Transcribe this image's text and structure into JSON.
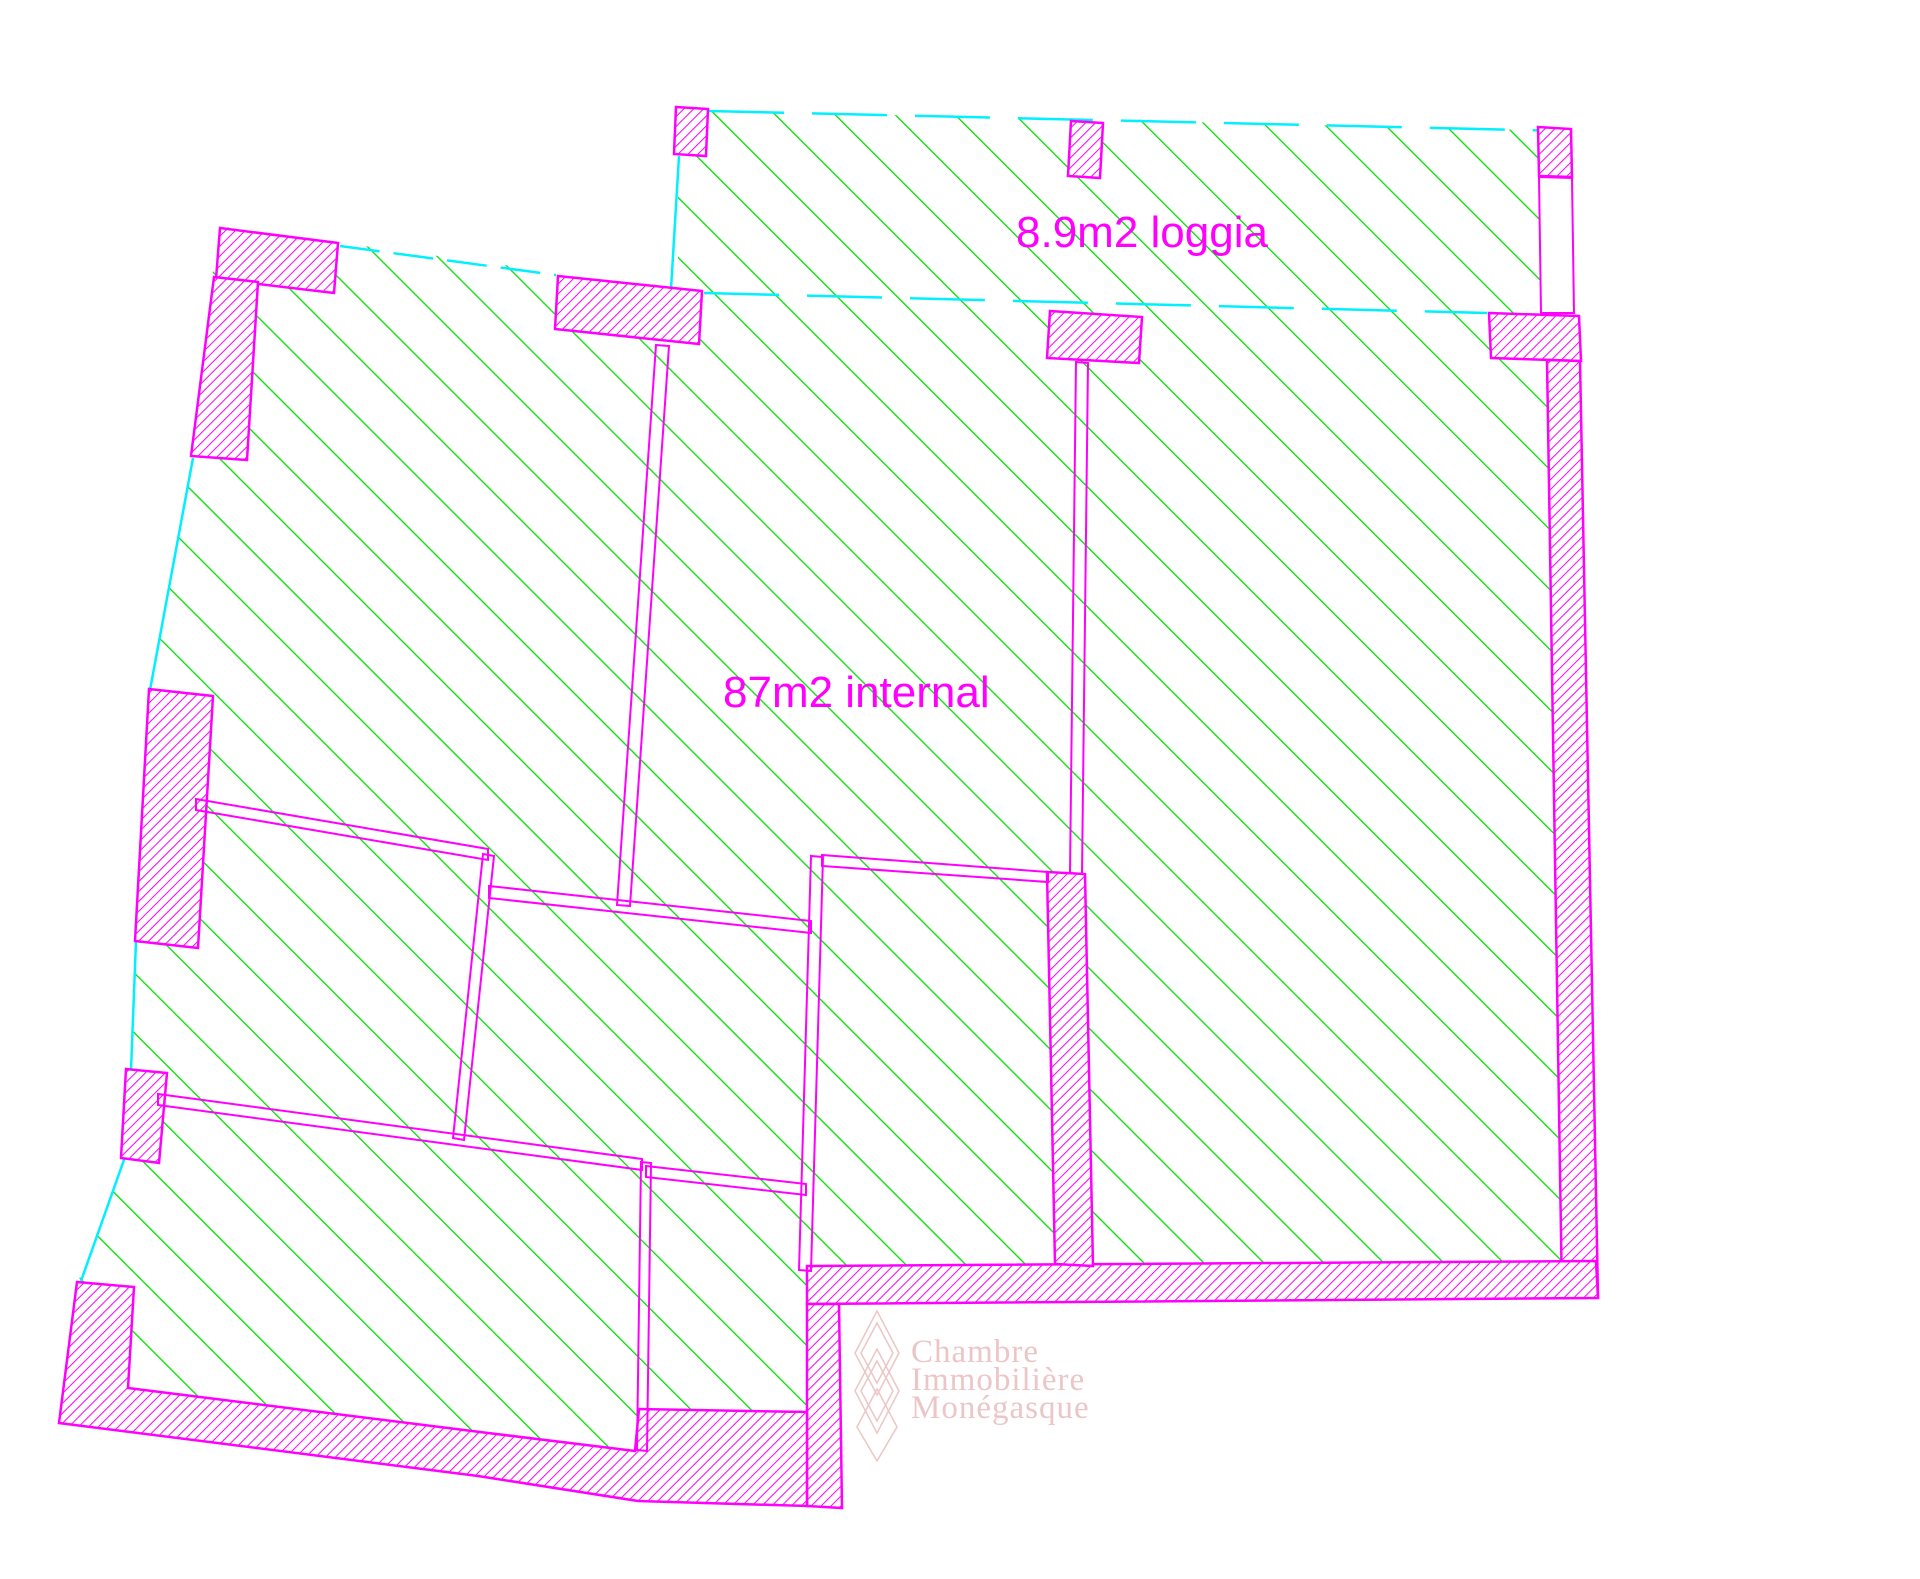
{
  "labels": {
    "internal_area": "87m2 internal",
    "loggia_area": "8.9m2 loggia"
  },
  "watermark": {
    "line1": "Chambre",
    "line2": "Immobilière",
    "line3": "Monégasque"
  },
  "colors": {
    "wall_magenta": "#FF00FF",
    "floor_hatch_green": "#00DF00",
    "boundary_cyan": "#00F0FF",
    "watermark_pink": "#ECC6C6",
    "background": "#FFFFFF"
  }
}
